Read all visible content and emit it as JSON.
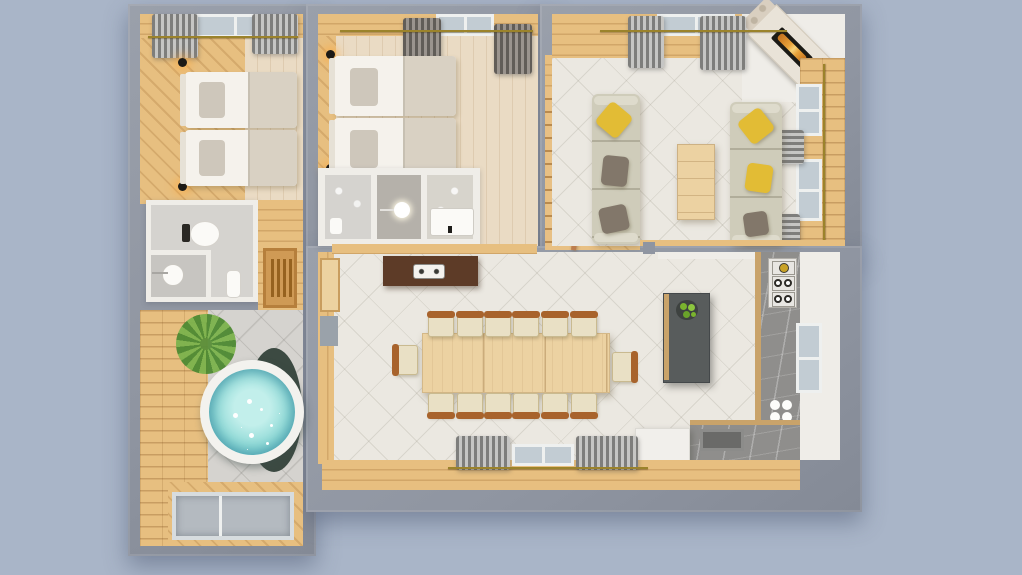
{
  "scene": {
    "description": "Top-down 3D architectural render of a furnished apartment floor plan on a blue-gray background, no visible text",
    "rooms": [
      {
        "name": "bedroom-1",
        "position": "top-left",
        "furniture": [
          "twin-bed",
          "twin-bed",
          "window",
          "curtains",
          "wall-sconce",
          "wall-sconce",
          "curtain-rod"
        ]
      },
      {
        "name": "bathroom-1",
        "position": "left-middle",
        "furniture": [
          "toilet",
          "round-sink",
          "bidet",
          "partition-wall"
        ]
      },
      {
        "name": "hallway",
        "position": "left-middle",
        "furniture": [
          "slatted-bench"
        ]
      },
      {
        "name": "spa-room",
        "position": "bottom-left",
        "furniture": [
          "round-hot-tub",
          "palm-plant",
          "glass-floor-panel",
          "plank-wall"
        ]
      },
      {
        "name": "bedroom-2",
        "position": "top-middle",
        "furniture": [
          "twin-bed",
          "twin-bed",
          "window",
          "curtains",
          "wall-sconce",
          "wall-sconce",
          "curtain-rod"
        ]
      },
      {
        "name": "bathroom-2",
        "position": "middle",
        "furniture": [
          "stone-floor",
          "round-sink",
          "shower-tray"
        ]
      },
      {
        "name": "staircase",
        "position": "center",
        "furniture": [
          "stairs",
          "copper-handrail",
          "landing"
        ]
      },
      {
        "name": "living-room",
        "position": "top-right",
        "furniture": [
          "sofa",
          "sofa",
          "coffee-table",
          "corner-fireplace",
          "windows",
          "curtains",
          "throw-pillows",
          "curtain-rod"
        ]
      },
      {
        "name": "dining-kitchen",
        "position": "bottom-right",
        "furniture": [
          "dining-table",
          "chairs-x14",
          "sideboard",
          "kitchen-island",
          "fruit-bowl",
          "gas-cooktop",
          "double-round-sink",
          "counter-sink",
          "white-cabinet",
          "window",
          "curtains",
          "door",
          "l-shaped-counter"
        ]
      }
    ]
  },
  "colors": {
    "bg": "#a9b5c8",
    "wall": "#8f95a1",
    "white-wall": "#efede8",
    "wood": "#e7bf80",
    "floor": "#eadbc4",
    "tile": "#ebe8e1",
    "gray-tile": "#d5d3cf",
    "gray-tile-dark": "#c7c5c1",
    "curtain-a": "#c6c6c4",
    "curtain-b": "#7e7e7c",
    "curtain-dark-a": "#9a948e",
    "curtain-dark-b": "#615d58",
    "rod": "#9b832b",
    "glass": "#c2ccd3",
    "glass-floor": "#b4bac0",
    "bed": "#f5f2ec",
    "headboard": "#e6e1d6",
    "pillow": "#cec7bb",
    "blanket": "#d9d1c3",
    "sofa": "#cfccba",
    "pillow-yellow": "#e2bc35",
    "pillow-brown": "#82776a",
    "table-wood": "#ecd2a2",
    "chair-wood": "#a8632c",
    "chair-cushion": "#e9e0c5",
    "sideboard": "#5d3b27",
    "island": "#585c5c",
    "island-edge": "#c9a36a",
    "marble": "#8f8e8c",
    "steel": "#e8e6e2",
    "burner-brass": "#c9a227",
    "water": "#8ed9d6",
    "water-deep": "#2e8fa0",
    "tub-rim": "#f3f2ee",
    "tub-shadow": "#3c4a42",
    "plant": "#7cb34d",
    "plant-dark": "#4e8a33",
    "rail": "#bd7e4e",
    "mantel": "#e9e3d8",
    "firebox": "#1b1a15",
    "fire": "#e8a23a",
    "sink-dark": "#6a6a68",
    "fridge": "#f1efeb"
  }
}
